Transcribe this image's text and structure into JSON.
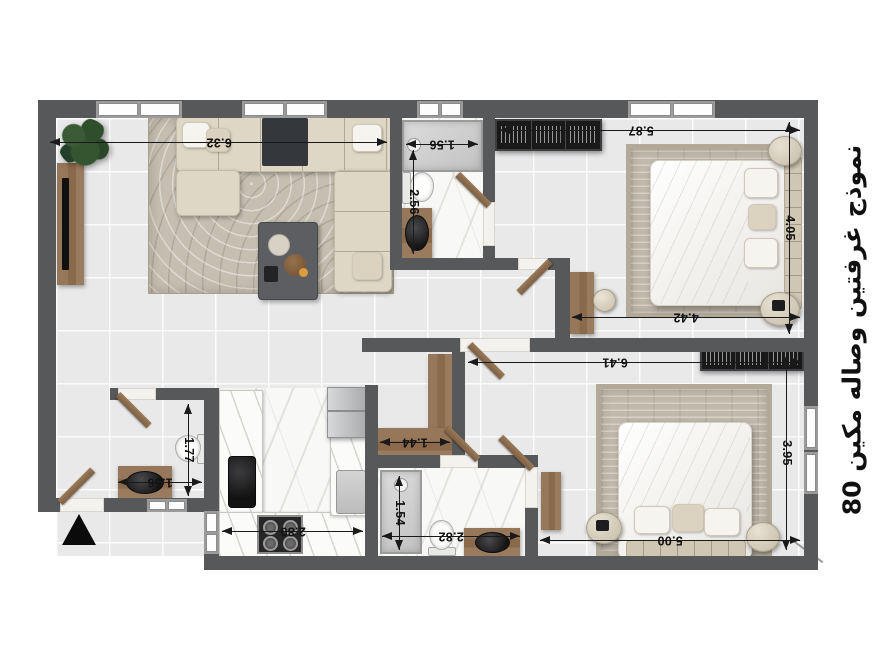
{
  "title": {
    "text": "نموذج غرفتين وصاله مكين 80"
  },
  "dimensions": {
    "living_width": "6.32",
    "bath1_shower_width": "1.56",
    "bath1_length": "2.56",
    "bedroom1_width": "5.87",
    "bedroom1_depth": "4.05",
    "bedroom1_lower_width": "4.42",
    "bedroom2_width": "6.41",
    "bedroom2_depth": "3.95",
    "bedroom2_lower_width": "5.00",
    "kitchen_width": "2.80",
    "hall_cabinet_width": "1.44",
    "bath2_shower_length": "1.54",
    "bath2_width": "2.82",
    "wc_depth": "1.77",
    "wc_width": "1.56"
  },
  "colors": {
    "wall": "#57585a",
    "floor_tile": "#e9e9ea",
    "marble": "#f8f8f7",
    "wood": "#8a6a4b",
    "rug": "#c3bcae",
    "dimension_text": "#121212"
  }
}
